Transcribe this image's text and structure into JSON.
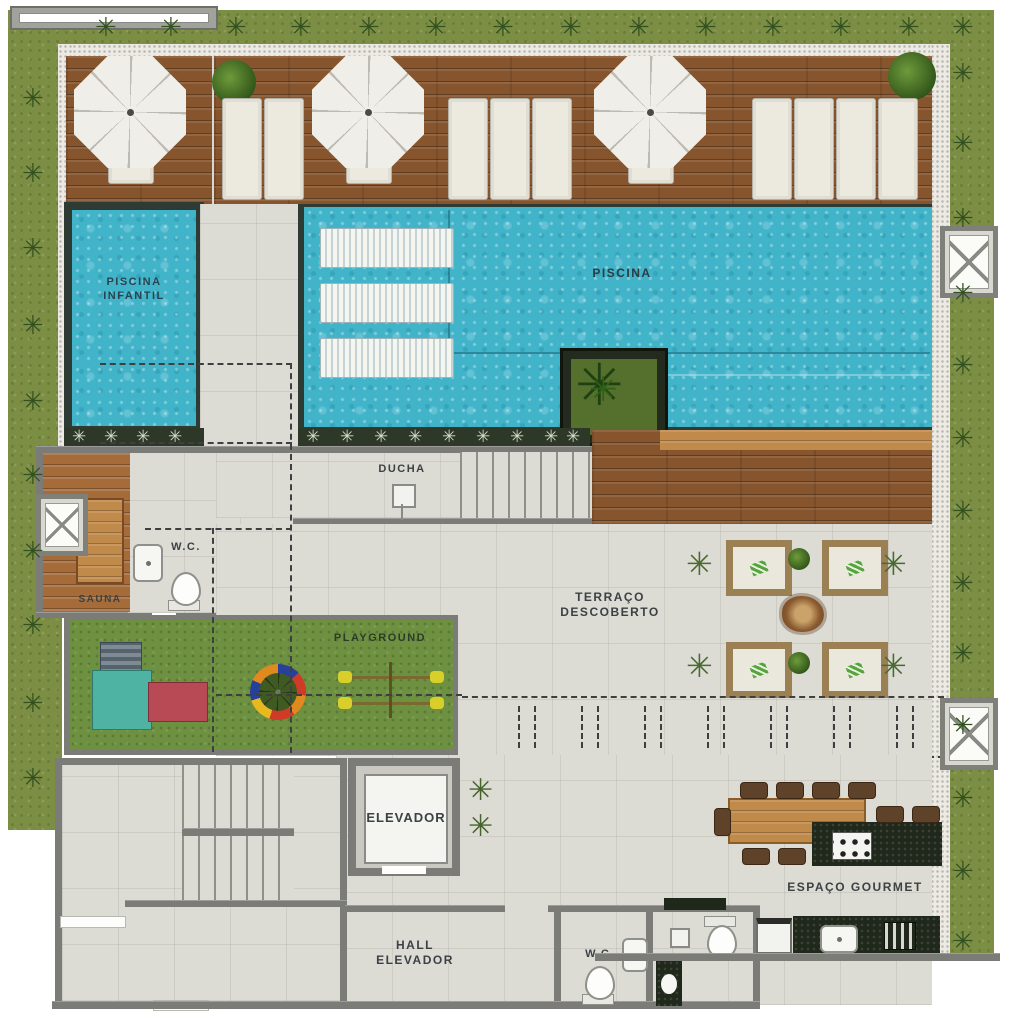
{
  "plan_labels": {
    "piscina_infantil": {
      "line1": "PISCINA",
      "line2": "INFANTIL"
    },
    "piscina": "PISCINA",
    "ducha": "DUCHA",
    "sauna": "SAUNA",
    "wc_upper": "W.C.",
    "playground": "PLAYGROUND",
    "terraco_descoberto": {
      "line1": "TERRAÇO",
      "line2": "DESCOBERTO"
    },
    "elevador": "ELEVADOR",
    "hall_elevador": {
      "line1": "HALL",
      "line2": "ELEVADOR"
    },
    "wc_lower": "W.C.",
    "espaco_gourmet": "ESPAÇO GOURMET"
  },
  "icons": {
    "accessible": "♿",
    "palm_plant": "✳"
  },
  "colors": {
    "water": "#41b4ca",
    "deck_wood": "#86552d",
    "grass": "#7c8e44",
    "playground_grass": "#6d9140",
    "tile_floor": "#dcdbd4",
    "wall_gray": "#7b7b78",
    "counter_dark": "#20281c",
    "accessibility_blue": "#1f62b8",
    "table_wood": "#c08a4a"
  }
}
